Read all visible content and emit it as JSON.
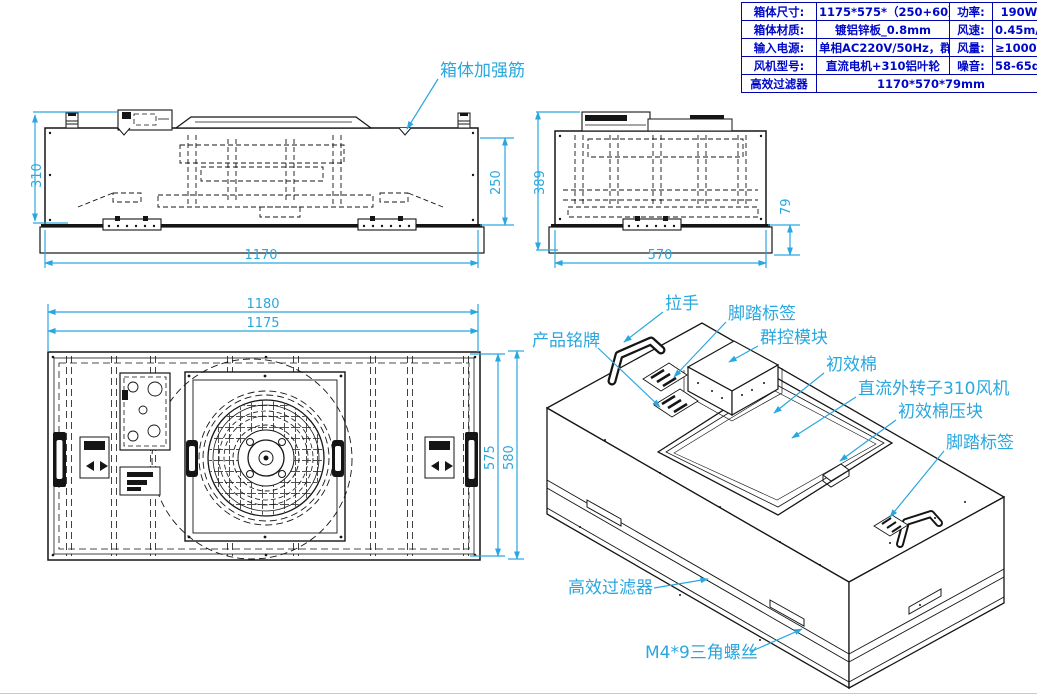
{
  "spec_table": {
    "rows": [
      {
        "k1": "箱体尺寸:",
        "v1": "1175*575*（250+60）mm",
        "k2": "功率:",
        "v2": "190W"
      },
      {
        "k1": "箱体材质:",
        "v1": "镀铝锌板_0.8mm",
        "k2": "风速:",
        "v2": "0.45m/s±20%"
      },
      {
        "k1": "输入电源:",
        "v1": "单相AC220V/50Hz，群控",
        "k2": "风量:",
        "v2": "≥1000 m3/h"
      },
      {
        "k1": "风机型号:",
        "v1": "直流电机+310铝叶轮",
        "k2": "噪音:",
        "v2": "58-65dB"
      }
    ],
    "footer": {
      "k": "高效过滤器",
      "v": "1170*570*79mm"
    }
  },
  "dims": {
    "front_height": "310",
    "front_inner": "250",
    "front_width": "1170",
    "side_height": "389",
    "side_filter": "79",
    "side_width": "570",
    "top_w_outer": "1180",
    "top_w_inner": "1175",
    "top_h_inner": "575",
    "top_h_outer": "580"
  },
  "callouts": {
    "reinforce": "箱体加强筋",
    "handle": "拉手",
    "foot_label_1": "脚踏标签",
    "nameplate": "产品铭牌",
    "control_module": "群控模块",
    "prefilter": "初效棉",
    "dc_fan": "直流外转子310风机",
    "prefilter_clamp": "初效棉压块",
    "foot_label_2": "脚踏标签",
    "hepa": "高效过滤器",
    "screw": "M4*9三角螺丝"
  },
  "colors": {
    "dimension_accent": "#2AA7DF",
    "table_blue": "#0008C8"
  }
}
